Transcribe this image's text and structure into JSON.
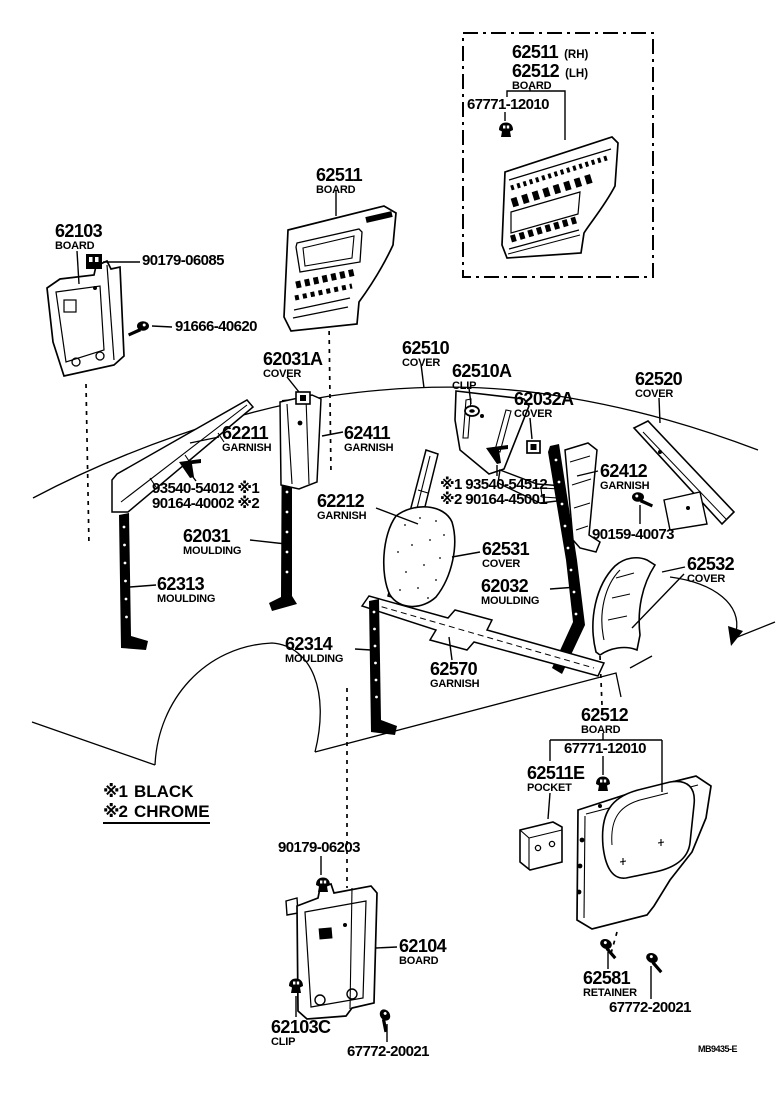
{
  "page": {
    "background": "#ffffff",
    "ink": "#000000"
  },
  "doc_code": "MB9435-E",
  "inset": {
    "part1": "62511",
    "part1_side": "(RH)",
    "part2": "62512",
    "part2_side": "(LH)",
    "name": "BOARD",
    "fastener": "67771-12010"
  },
  "legend": {
    "entries": [
      {
        "marker": "※1",
        "label": "BLACK"
      },
      {
        "marker": "※2",
        "label": "CHROME"
      }
    ]
  },
  "callouts": {
    "board_62103": {
      "number": "62103",
      "name": "BOARD"
    },
    "clip_90179_06085": {
      "number": "90179-06085"
    },
    "screw_91666_40620": {
      "number": "91666-40620"
    },
    "board_62511": {
      "number": "62511",
      "name": "BOARD"
    },
    "cover_62031a": {
      "number": "62031A",
      "name": "COVER"
    },
    "cover_62510": {
      "number": "62510",
      "name": "COVER"
    },
    "clip_62510a": {
      "number": "62510A",
      "name": "CLIP"
    },
    "cover_62032a": {
      "number": "62032A",
      "name": "COVER"
    },
    "cover_62520": {
      "number": "62520",
      "name": "COVER"
    },
    "garnish_62211": {
      "number": "62211",
      "name": "GARNISH"
    },
    "garnish_62411": {
      "number": "62411",
      "name": "GARNISH"
    },
    "screws_front": {
      "line1": "93540-54012 ※1",
      "line2": "90164-40002 ※2"
    },
    "garnish_62212": {
      "number": "62212",
      "name": "GARNISH"
    },
    "screws_center": {
      "line1": "※1 93540-54512",
      "line2": "※2 90164-45001"
    },
    "garnish_62412": {
      "number": "62412",
      "name": "GARNISH"
    },
    "screw_90159_40073": {
      "number": "90159-40073"
    },
    "moulding_62031": {
      "number": "62031",
      "name": "MOULDING"
    },
    "moulding_62313": {
      "number": "62313",
      "name": "MOULDING"
    },
    "cover_62531": {
      "number": "62531",
      "name": "COVER"
    },
    "moulding_62032": {
      "number": "62032",
      "name": "MOULDING"
    },
    "cover_62532": {
      "number": "62532",
      "name": "COVER"
    },
    "moulding_62314": {
      "number": "62314",
      "name": "MOULDING"
    },
    "garnish_62570": {
      "number": "62570",
      "name": "GARNISH"
    },
    "board_62512": {
      "number": "62512",
      "name": "BOARD"
    },
    "clip_67771_12010": {
      "number": "67771-12010"
    },
    "pocket_62511e": {
      "number": "62511E",
      "name": "POCKET"
    },
    "retainer_62581": {
      "number": "62581",
      "name": "RETAINER"
    },
    "screw_67772_20021_r": {
      "number": "67772-20021"
    },
    "clip_90179_06203": {
      "number": "90179-06203"
    },
    "board_62104": {
      "number": "62104",
      "name": "BOARD"
    },
    "clip_62103c": {
      "number": "62103C",
      "name": "CLIP"
    },
    "screw_67772_20021_b": {
      "number": "67772-20021"
    }
  }
}
